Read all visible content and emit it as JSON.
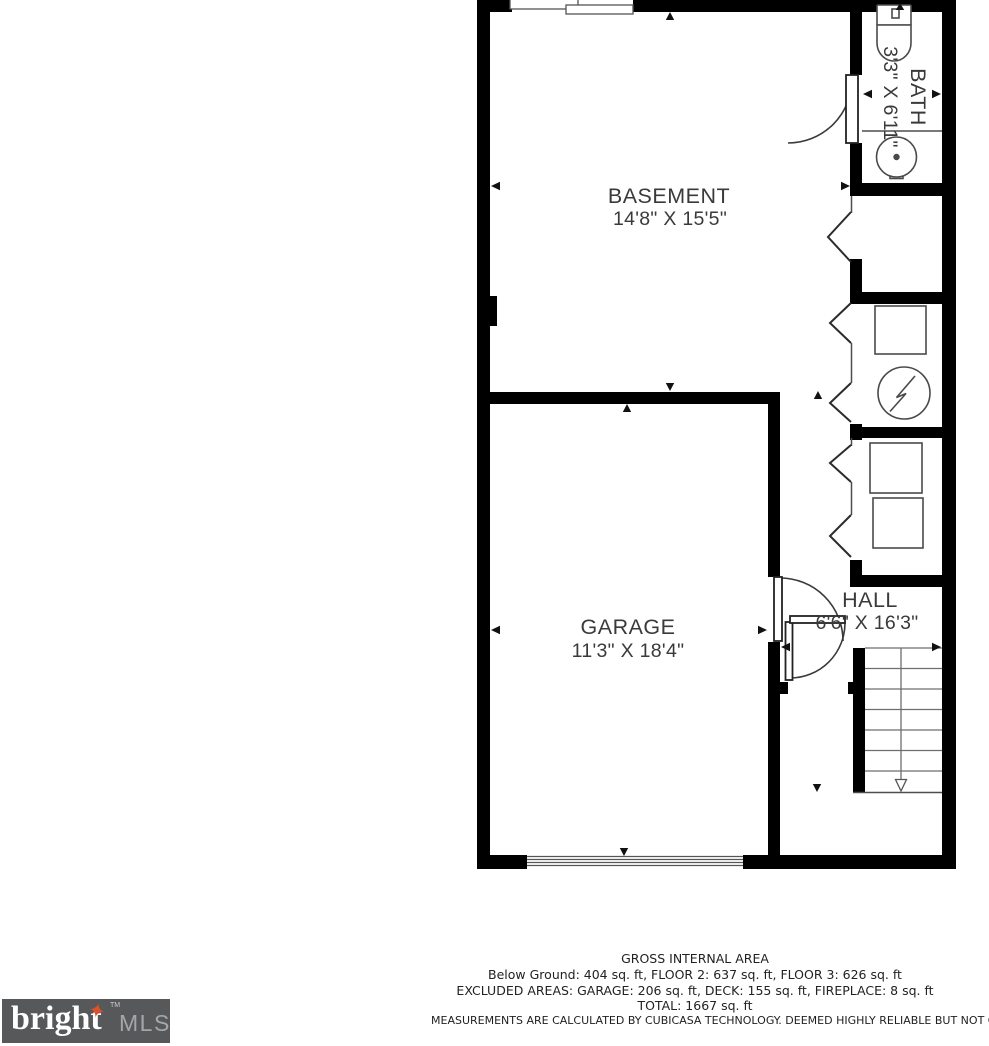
{
  "plan": {
    "rooms": [
      {
        "name": "BASEMENT",
        "dims": "14'8\" X 15'5\""
      },
      {
        "name": "GARAGE",
        "dims": "11'3\" X 18'4\""
      },
      {
        "name": "HALL",
        "dims": "6'6\" X 16'3\""
      },
      {
        "name": "BATH",
        "dims": "3'3\" X 6'11\""
      }
    ]
  },
  "footer": {
    "title": "GROSS INTERNAL AREA",
    "line1": "Below Ground: 404 sq. ft, FLOOR 2: 637 sq. ft, FLOOR 3: 626 sq. ft",
    "line2": "EXCLUDED AREAS: GARAGE: 206 sq. ft, DECK: 155 sq. ft, FIREPLACE: 8 sq. ft",
    "total": "TOTAL: 1667 sq. ft",
    "disclaimer": "MEASUREMENTS ARE CALCULATED BY CUBICASA TECHNOLOGY. DEEMED HIGHLY RELIABLE BUT NOT GUARANTEED"
  },
  "logo": {
    "brand": "bright",
    "suffix": "MLS",
    "tm": "TM",
    "star": "✦"
  },
  "colors": {
    "background": "#ffffff",
    "wall": "#000000",
    "thin_line": "#4d4d4d",
    "stair_line": "#6e6e6e",
    "fixture_line": "#4a4a4a",
    "door_line": "#3a3a3a",
    "arrow": "#111111",
    "label_text": "#3a3a3a",
    "footer_text": "#222222",
    "logo_bg": "#57585a",
    "logo_text": "#ffffff",
    "logo_mls_text": "#a4a6a9",
    "logo_star": "#d8532a"
  }
}
